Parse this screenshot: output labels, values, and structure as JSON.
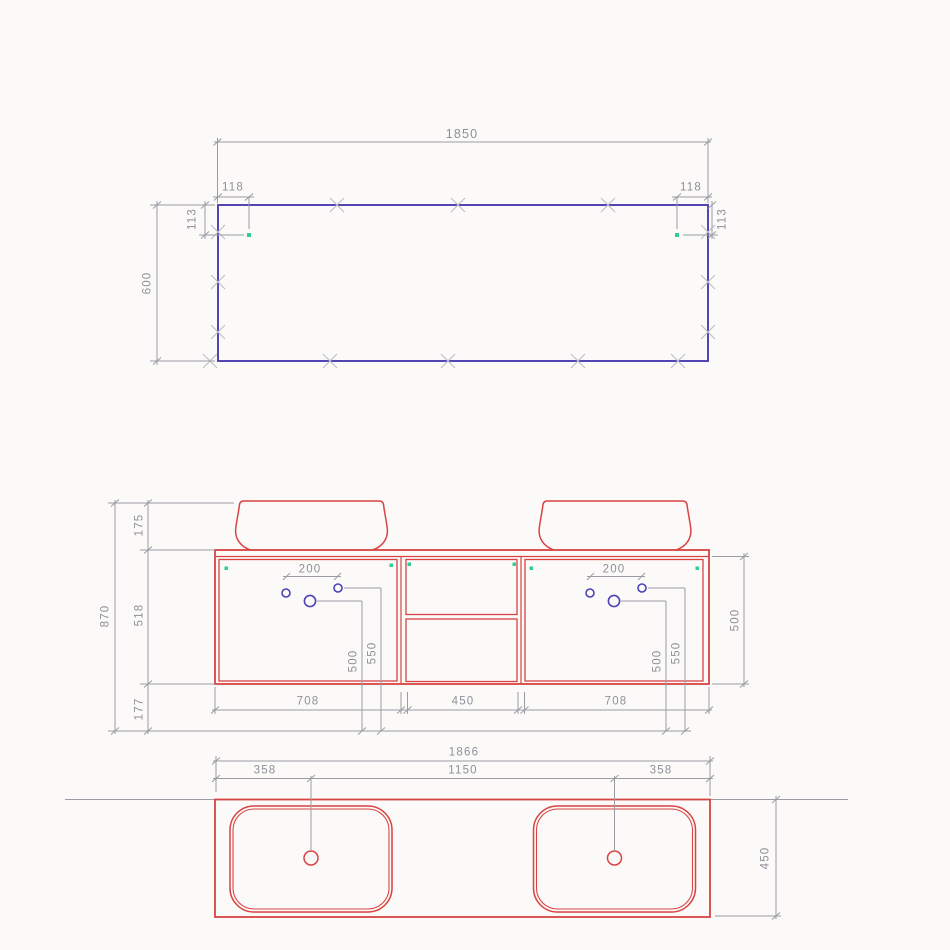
{
  "colors": {
    "outline_blue": "#5246b4",
    "outline_red": "#d84343",
    "hole_blue": "#4a42b5",
    "dim_gray": "#9b9ba3",
    "text_gray": "#8f8f99",
    "cross_gray": "#bcbcc6",
    "marker_green": "#2fce96"
  },
  "top_view": {
    "width": "1850",
    "height": "600",
    "hole_offset_left": "118",
    "hole_offset_right": "118",
    "hole_down_left": "113",
    "hole_down_right": "113"
  },
  "front_view": {
    "total_height": "870",
    "basin_height": "175",
    "cabinet_height": "518",
    "wall_clearance": "177",
    "hole_spacing_left": "200",
    "hole_spacing_right": "200",
    "hole_height_500_left": "500",
    "hole_height_550_left": "550",
    "hole_height_500_right": "500",
    "hole_height_550_right": "550",
    "carcass_height": "500",
    "door_left_width": "708",
    "drawer_section_width": "450",
    "door_right_width": "708"
  },
  "plan_view": {
    "total_width": "1866",
    "basin_center_offset_left": "358",
    "basin_center_spacing": "1150",
    "basin_center_offset_right": "358",
    "depth": "450"
  }
}
